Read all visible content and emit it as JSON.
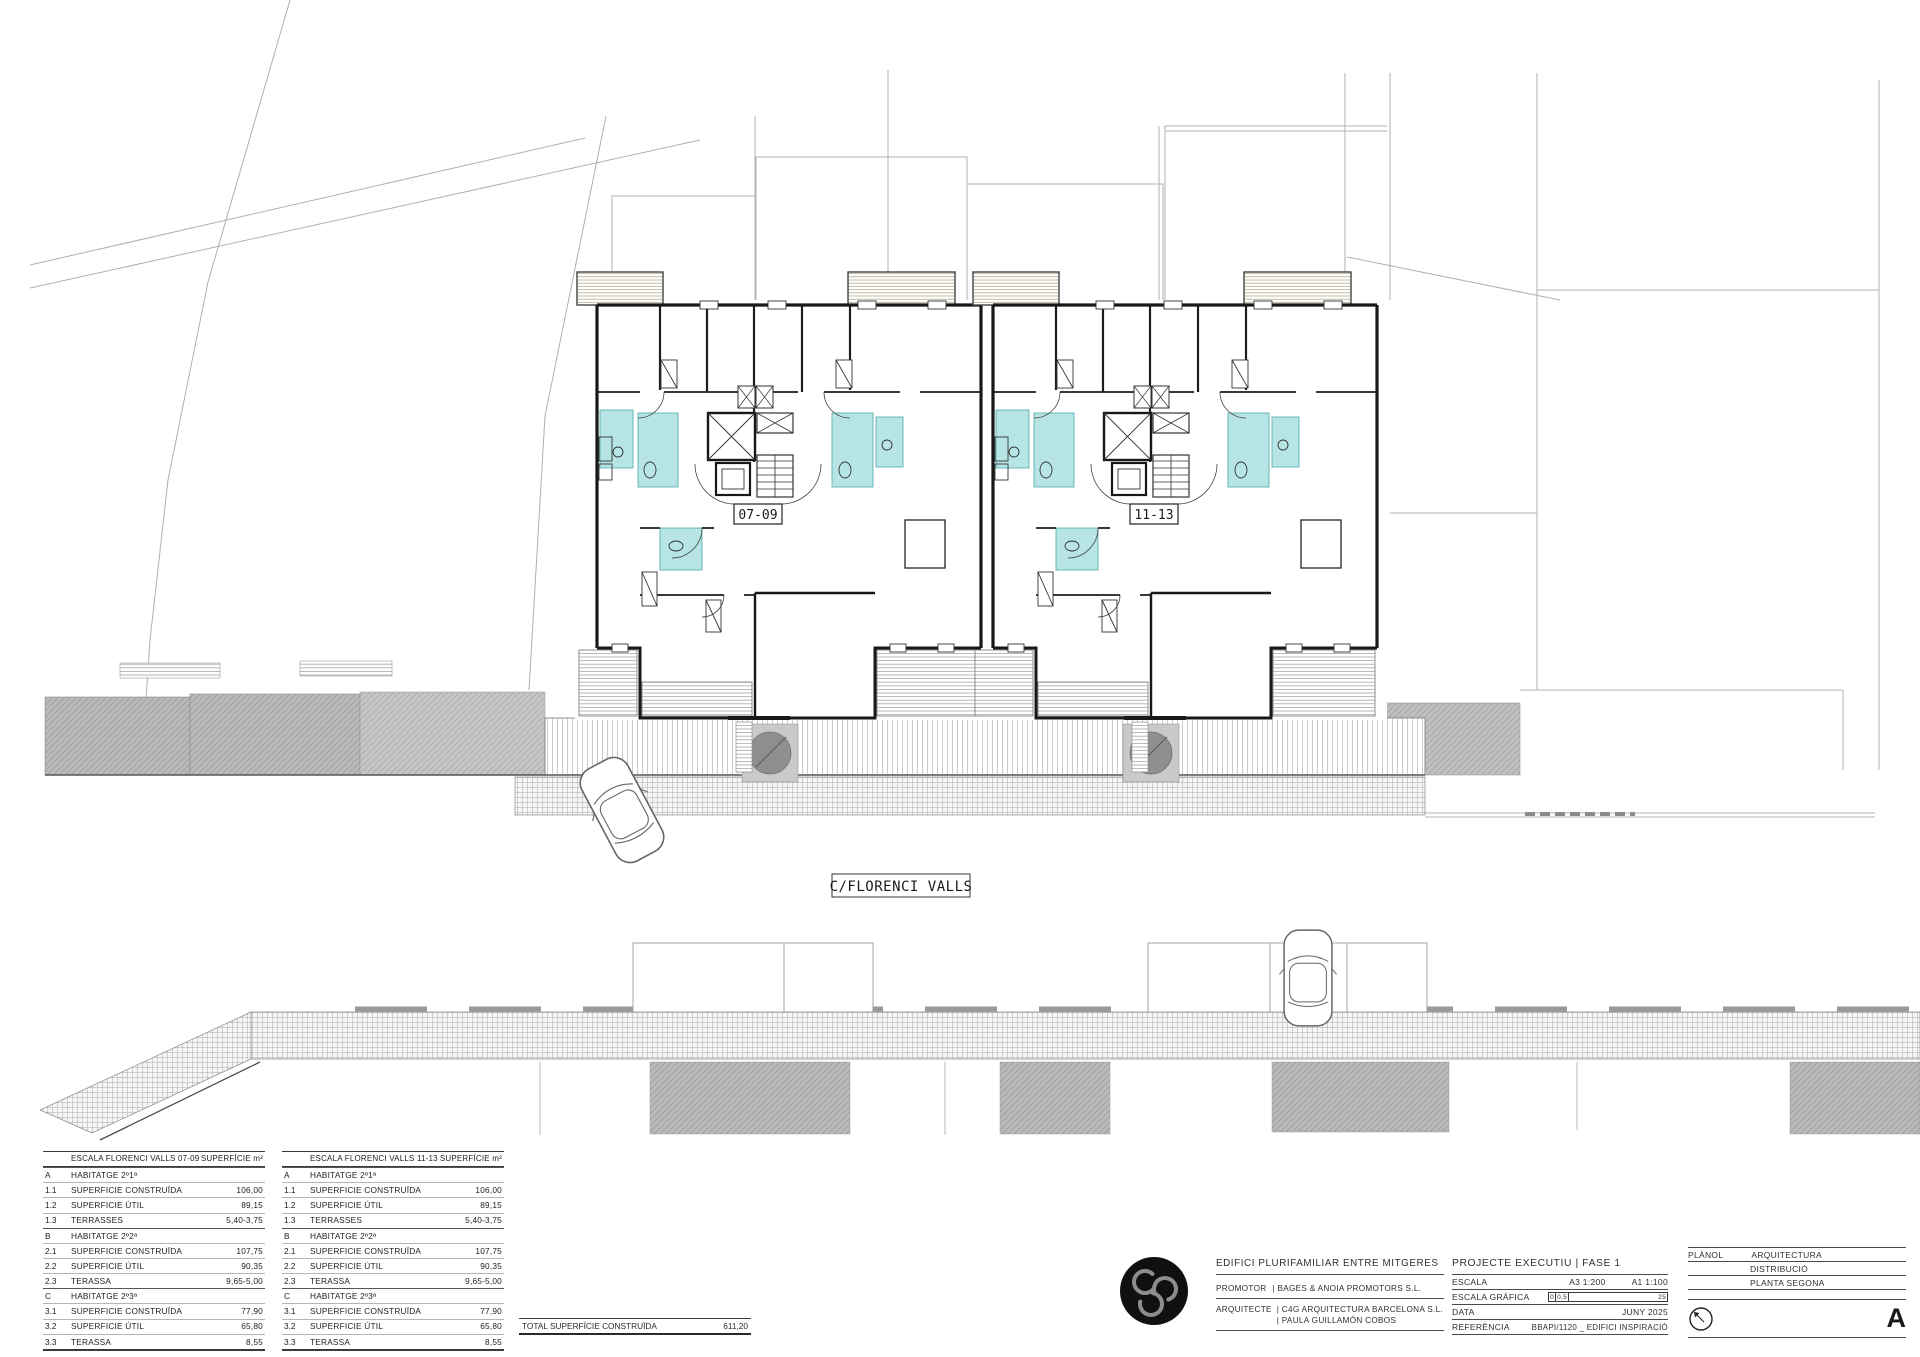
{
  "plan": {
    "street_label": "C/FLORENCI VALLS",
    "unit_labels": {
      "left": "07-09",
      "right": "11-13"
    },
    "colors": {
      "bathroom": "#b7e4e4",
      "tree_canopy": "#8f8f8f",
      "tree_pit": "#c9c9c9",
      "neighbor_mass": "#b9b9b9",
      "pergola_hatch": "#b3aa8c"
    }
  },
  "area_tables": [
    {
      "title": "ESCALA FLORENCI VALLS   07-09",
      "header_right": "SUPERFÍCIE m²",
      "rows": [
        {
          "code": "A",
          "label": "HABITATGE 2º1ª",
          "value": "",
          "group": true
        },
        {
          "code": "1.1",
          "label": "SUPERFICIE  CONSTRUÏDA",
          "value": "106,00"
        },
        {
          "code": "1.2",
          "label": "SUPERFICIE  ÚTIL",
          "value": "89,15"
        },
        {
          "code": "1.3",
          "label": "TERRASSES",
          "value": "5,40-3,75"
        },
        {
          "code": "B",
          "label": "HABITATGE 2º2ª",
          "value": "",
          "group": true
        },
        {
          "code": "2.1",
          "label": "SUPERFICIE  CONSTRUÏDA",
          "value": "107,75"
        },
        {
          "code": "2.2",
          "label": "SUPERFICIE  ÚTIL",
          "value": "90,35"
        },
        {
          "code": "2.3",
          "label": "TERASSA",
          "value": "9,65-5,00"
        },
        {
          "code": "C",
          "label": "HABITATGE 2º3ª",
          "value": "",
          "group": true
        },
        {
          "code": "3.1",
          "label": "SUPERFICIE  CONSTRUÏDA",
          "value": "77,90"
        },
        {
          "code": "3.2",
          "label": "SUPERFICIE  ÚTIL",
          "value": "65,80"
        },
        {
          "code": "3.3",
          "label": "TERASSA",
          "value": "8,55"
        }
      ]
    },
    {
      "title": "ESCALA FLORENCI VALLS   11-13",
      "header_right": "SUPERFÍCIE m²",
      "rows": [
        {
          "code": "A",
          "label": "HABITATGE 2º1ª",
          "value": "",
          "group": true
        },
        {
          "code": "1.1",
          "label": "SUPERFICIE  CONSTRUÏDA",
          "value": "106,00"
        },
        {
          "code": "1.2",
          "label": "SUPERFICIE  ÚTIL",
          "value": "89,15"
        },
        {
          "code": "1.3",
          "label": "TERRASSES",
          "value": "5,40-3,75"
        },
        {
          "code": "B",
          "label": "HABITATGE 2º2ª",
          "value": "",
          "group": true
        },
        {
          "code": "2.1",
          "label": "SUPERFICIE  CONSTRUÏDA",
          "value": "107,75"
        },
        {
          "code": "2.2",
          "label": "SUPERFICIE  ÚTIL",
          "value": "90,35"
        },
        {
          "code": "2.3",
          "label": "TERASSA",
          "value": "9,65-5,00"
        },
        {
          "code": "C",
          "label": "HABITATGE 2º3ª",
          "value": "",
          "group": true
        },
        {
          "code": "3.1",
          "label": "SUPERFICIE  CONSTRUÏDA",
          "value": "77,90"
        },
        {
          "code": "3.2",
          "label": "SUPERFICIE  ÚTIL",
          "value": "65,80"
        },
        {
          "code": "3.3",
          "label": "TERASSA",
          "value": "8,55"
        }
      ]
    }
  ],
  "total_row": {
    "label": "TOTAL SUPERFÍCIE CONSTRUÏDA",
    "value": "611,20"
  },
  "title_block": {
    "project_title": "EDIFICI PLURIFAMILIAR ENTRE MITGERES",
    "promotor_label": "PROMOTOR",
    "promotor_value": "| BAGES & ANOIA PROMOTORS S.L.",
    "arquitecte_label": "ARQUITECTE",
    "arquitecte_value1": "| C4G ARQUITECTURA BARCELONA S.L.",
    "arquitecte_value2": "| PAULA GUILLAMÓN COBOS",
    "phase_title": "PROJECTE EXECUTIU | FASE 1",
    "escala_label": "ESCALA",
    "escala_a3": "A3   1:200",
    "escala_a1": "A1   1:100",
    "escala_grafica_label": "ESCALA GRÀFICA",
    "scalebar": [
      "0",
      "0,5",
      "25"
    ],
    "data_label": "DATA",
    "data_value": "JUNY 2025",
    "referencia_label": "REFERÈNCIA",
    "referencia_value": "BBAPI/1120 _ EDIFICI INSPIRACIÓ",
    "planol_label": "PLÀNOL",
    "planol_value": "ARQUITECTURA",
    "planol_sub1": "DISTRIBUCIÓ",
    "planol_sub2": "PLANTA SEGONA",
    "sheet_letter": "A"
  }
}
